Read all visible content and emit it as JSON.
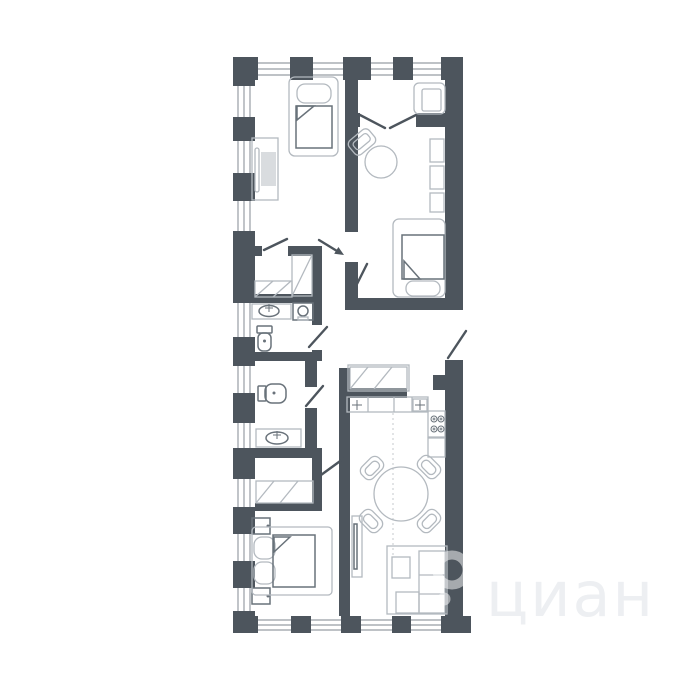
{
  "watermark": {
    "text": "циан",
    "logo": "cian-ring-logo"
  },
  "colors": {
    "wall": "#4d555d",
    "window_line": "#989ea5",
    "furniture_light": "#b3b9bf",
    "furniture_dark": "#69727a",
    "soft_fill": "#d9dcdf",
    "dash": "#c4c8cc",
    "watermark_text": "#edeff2",
    "background": "#ffffff"
  },
  "plan": {
    "type": "apartment-floor-plan",
    "furniture_icons": [
      "single-bed-icon",
      "desk-icon",
      "desk-chair-icon",
      "armchair-icon",
      "round-table-icon",
      "chair-icon",
      "wall-shelves-icon",
      "wardrobe-hangers-icon",
      "shelf-unit-icon",
      "washing-machine-icon",
      "bathroom-sink-icon",
      "toilet-icon",
      "kitchen-counter-icon",
      "kitchen-sink-icon",
      "stove-icon",
      "fridge-icon",
      "dining-table-icon",
      "dining-chair-icon",
      "corner-sofa-icon",
      "coffee-table-icon",
      "tv-console-icon",
      "double-bed-icon",
      "nightstand-icon",
      "entrance-arrow-icon",
      "door-swing-icon",
      "window-icon"
    ]
  }
}
